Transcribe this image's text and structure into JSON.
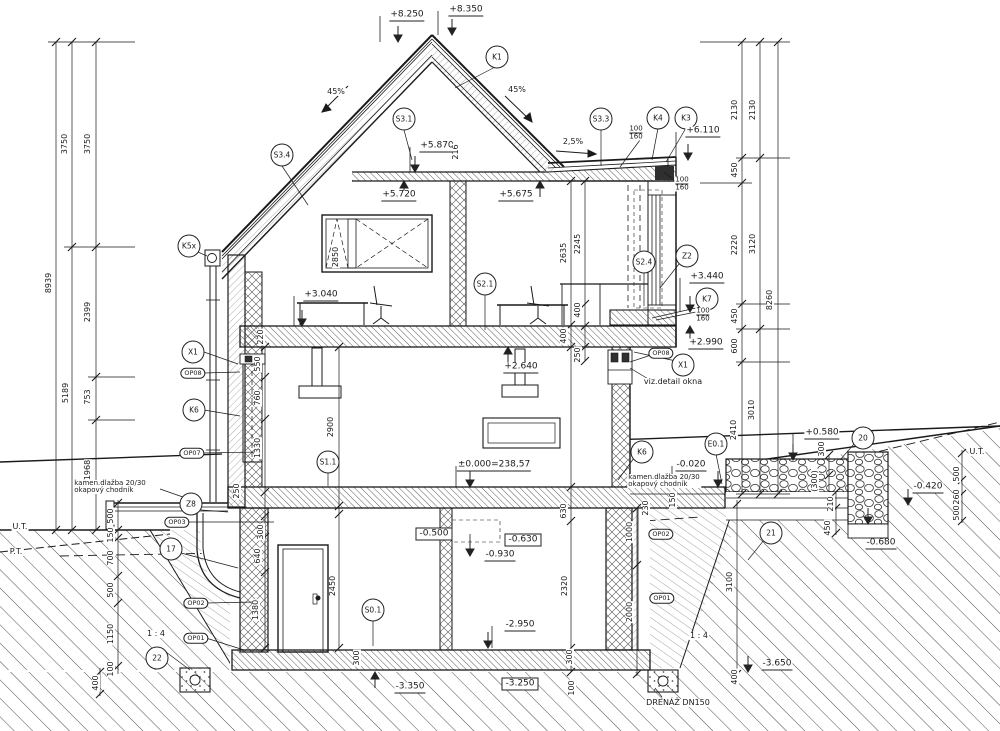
{
  "drawing": {
    "kind": "building cross-section",
    "ink": "#1a1a1a"
  },
  "annotations": {
    "circles": [
      {
        "t": "K1",
        "x": 497,
        "y": 57
      },
      {
        "t": "S3.1",
        "x": 404,
        "y": 119
      },
      {
        "t": "S3.3",
        "x": 601,
        "y": 119
      },
      {
        "t": "K4",
        "x": 658,
        "y": 118
      },
      {
        "t": "K3",
        "x": 686,
        "y": 118
      },
      {
        "t": "S3.4",
        "x": 282,
        "y": 155
      },
      {
        "t": "K5x",
        "x": 189,
        "y": 246
      },
      {
        "t": "S2.1",
        "x": 485,
        "y": 284
      },
      {
        "t": "S2.4",
        "x": 644,
        "y": 262
      },
      {
        "t": "Z2",
        "x": 687,
        "y": 256
      },
      {
        "t": "K7",
        "x": 707,
        "y": 299
      },
      {
        "t": "X1",
        "x": 683,
        "y": 365
      },
      {
        "t": "X1",
        "x": 193,
        "y": 352
      },
      {
        "t": "K6",
        "x": 194,
        "y": 410
      },
      {
        "t": "K6",
        "x": 642,
        "y": 452
      },
      {
        "t": "E0.1",
        "x": 716,
        "y": 444
      },
      {
        "t": "20",
        "x": 863,
        "y": 438
      },
      {
        "t": "Z8",
        "x": 191,
        "y": 504
      },
      {
        "t": "17",
        "x": 171,
        "y": 549
      },
      {
        "t": "22",
        "x": 157,
        "y": 658
      },
      {
        "t": "21",
        "x": 771,
        "y": 533
      },
      {
        "t": "S1.1",
        "x": 328,
        "y": 462
      },
      {
        "t": "S0.1",
        "x": 373,
        "y": 610
      }
    ],
    "ovals": [
      {
        "t": "OP08",
        "x": 193,
        "y": 373
      },
      {
        "t": "OP07",
        "x": 192,
        "y": 453
      },
      {
        "t": "OP08",
        "x": 661,
        "y": 353
      },
      {
        "t": "OP03",
        "x": 177,
        "y": 522
      },
      {
        "t": "OP02",
        "x": 196,
        "y": 603
      },
      {
        "t": "OP01",
        "x": 196,
        "y": 638
      },
      {
        "t": "OP02",
        "x": 661,
        "y": 534
      },
      {
        "t": "OP01",
        "x": 662,
        "y": 598
      }
    ],
    "elevations": [
      {
        "t": "+8.250",
        "x": 407,
        "y": 16,
        "s": "u"
      },
      {
        "t": "+8.350",
        "x": 466,
        "y": 11,
        "s": "u"
      },
      {
        "t": "+5.870",
        "x": 437,
        "y": 147,
        "s": "u"
      },
      {
        "t": "+5.720",
        "x": 399,
        "y": 196,
        "s": "u"
      },
      {
        "t": "+5.675",
        "x": 516,
        "y": 196,
        "s": "u"
      },
      {
        "t": "+6.110",
        "x": 703,
        "y": 132,
        "s": "u"
      },
      {
        "t": "+3.040",
        "x": 321,
        "y": 296,
        "s": "u"
      },
      {
        "t": "+3.440",
        "x": 707,
        "y": 278,
        "s": "u"
      },
      {
        "t": "+2.990",
        "x": 706,
        "y": 344,
        "s": "u"
      },
      {
        "t": "+2.640",
        "x": 521,
        "y": 368,
        "s": "u"
      },
      {
        "t": "±0.000=238,57",
        "x": 494,
        "y": 466,
        "s": "u"
      },
      {
        "t": "-0.020",
        "x": 691,
        "y": 466,
        "s": "u"
      },
      {
        "t": "+0.580",
        "x": 822,
        "y": 434,
        "s": "u"
      },
      {
        "t": "-0.500",
        "x": 434,
        "y": 534,
        "s": "b"
      },
      {
        "t": "-0.630",
        "x": 523,
        "y": 540,
        "s": "b"
      },
      {
        "t": "-0.930",
        "x": 500,
        "y": 556,
        "s": "u"
      },
      {
        "t": "-2.950",
        "x": 520,
        "y": 626,
        "s": "u"
      },
      {
        "t": "-3.350",
        "x": 410,
        "y": 688,
        "s": "u"
      },
      {
        "t": "-3.250",
        "x": 520,
        "y": 684,
        "s": "b"
      },
      {
        "t": "-3.650",
        "x": 777,
        "y": 665,
        "s": "u"
      },
      {
        "t": "-0.680",
        "x": 881,
        "y": 544,
        "s": "u"
      },
      {
        "t": "-0.420",
        "x": 928,
        "y": 488,
        "s": "u"
      }
    ],
    "vdims": [
      {
        "t": "8939",
        "x": 49,
        "y": 283
      },
      {
        "t": "3750",
        "x": 65,
        "y": 144
      },
      {
        "t": "3750",
        "x": 88,
        "y": 144
      },
      {
        "t": "5189",
        "x": 66,
        "y": 393
      },
      {
        "t": "2399",
        "x": 88,
        "y": 312
      },
      {
        "t": "753",
        "x": 88,
        "y": 397
      },
      {
        "t": "1968",
        "x": 88,
        "y": 470
      },
      {
        "t": "2130",
        "x": 735,
        "y": 110
      },
      {
        "t": "2130",
        "x": 753,
        "y": 110
      },
      {
        "t": "450",
        "x": 735,
        "y": 170
      },
      {
        "t": "2220",
        "x": 735,
        "y": 245
      },
      {
        "t": "3120",
        "x": 753,
        "y": 244
      },
      {
        "t": "8260",
        "x": 770,
        "y": 300
      },
      {
        "t": "450",
        "x": 735,
        "y": 316
      },
      {
        "t": "600",
        "x": 735,
        "y": 346
      },
      {
        "t": "2410",
        "x": 734,
        "y": 430
      },
      {
        "t": "3010",
        "x": 752,
        "y": 410
      },
      {
        "t": "500",
        "x": 111,
        "y": 516
      },
      {
        "t": "150",
        "x": 111,
        "y": 535
      },
      {
        "t": "700",
        "x": 111,
        "y": 558
      },
      {
        "t": "500",
        "x": 111,
        "y": 590
      },
      {
        "t": "1150",
        "x": 111,
        "y": 634
      },
      {
        "t": "100",
        "x": 111,
        "y": 669
      },
      {
        "t": "400",
        "x": 96,
        "y": 683
      },
      {
        "t": "550",
        "x": 258,
        "y": 364
      },
      {
        "t": "760",
        "x": 258,
        "y": 398
      },
      {
        "t": "1330",
        "x": 258,
        "y": 448
      },
      {
        "t": "250",
        "x": 237,
        "y": 491
      },
      {
        "t": "300",
        "x": 261,
        "y": 532
      },
      {
        "t": "640",
        "x": 258,
        "y": 556
      },
      {
        "t": "1380",
        "x": 256,
        "y": 610
      },
      {
        "t": "2900",
        "x": 331,
        "y": 427
      },
      {
        "t": "2450",
        "x": 333,
        "y": 586
      },
      {
        "t": "2850",
        "x": 336,
        "y": 257
      },
      {
        "t": "216",
        "x": 456,
        "y": 152
      },
      {
        "t": "220",
        "x": 261,
        "y": 337
      },
      {
        "t": "2635",
        "x": 564,
        "y": 253
      },
      {
        "t": "2245",
        "x": 578,
        "y": 244
      },
      {
        "t": "400",
        "x": 578,
        "y": 310
      },
      {
        "t": "400",
        "x": 564,
        "y": 336
      },
      {
        "t": "250",
        "x": 578,
        "y": 355
      },
      {
        "t": "630",
        "x": 564,
        "y": 511
      },
      {
        "t": "2320",
        "x": 565,
        "y": 586
      },
      {
        "t": "300",
        "x": 570,
        "y": 657
      },
      {
        "t": "100",
        "x": 572,
        "y": 688
      },
      {
        "t": "300",
        "x": 357,
        "y": 658
      },
      {
        "t": "230",
        "x": 646,
        "y": 508
      },
      {
        "t": "150",
        "x": 673,
        "y": 500
      },
      {
        "t": "1000",
        "x": 630,
        "y": 532
      },
      {
        "t": "2000",
        "x": 630,
        "y": 612
      },
      {
        "t": "3100",
        "x": 730,
        "y": 582
      },
      {
        "t": "400",
        "x": 735,
        "y": 677
      },
      {
        "t": "300",
        "x": 822,
        "y": 449
      },
      {
        "t": "(300)",
        "x": 815,
        "y": 481
      },
      {
        "t": "210",
        "x": 831,
        "y": 504
      },
      {
        "t": "450",
        "x": 828,
        "y": 528
      },
      {
        "t": "500",
        "x": 957,
        "y": 474
      },
      {
        "t": "260",
        "x": 957,
        "y": 497
      },
      {
        "t": "500",
        "x": 957,
        "y": 513
      }
    ],
    "fractions": [
      {
        "top": "100",
        "bot": "160",
        "x": 636,
        "y": 133
      },
      {
        "top": "100",
        "bot": "160",
        "x": 682,
        "y": 184
      },
      {
        "top": "100",
        "bot": "160",
        "x": 703,
        "y": 315
      }
    ],
    "notes": [
      {
        "t": "45%",
        "x": 336,
        "y": 92
      },
      {
        "t": "45%",
        "x": 517,
        "y": 90
      },
      {
        "t": "2,5%",
        "x": 573,
        "y": 142
      },
      {
        "t": "U.T.",
        "x": 20,
        "y": 527
      },
      {
        "t": "P.T.",
        "x": 16,
        "y": 552
      },
      {
        "t": "U.T.",
        "x": 977,
        "y": 452
      },
      {
        "t": "1 : 4",
        "x": 156,
        "y": 634
      },
      {
        "t": "1 : 4",
        "x": 699,
        "y": 636
      },
      {
        "t": "viz.detail okna",
        "x": 673,
        "y": 382
      },
      {
        "t": "kamen.dlažba 20/30\nokapový chodník",
        "x": 110,
        "y": 487,
        "small": true
      },
      {
        "t": "kamen.dlažba 20/30\nokapový chodník",
        "x": 664,
        "y": 481,
        "small": true
      },
      {
        "t": "DRENÁŽ DN150",
        "x": 678,
        "y": 703
      }
    ]
  }
}
